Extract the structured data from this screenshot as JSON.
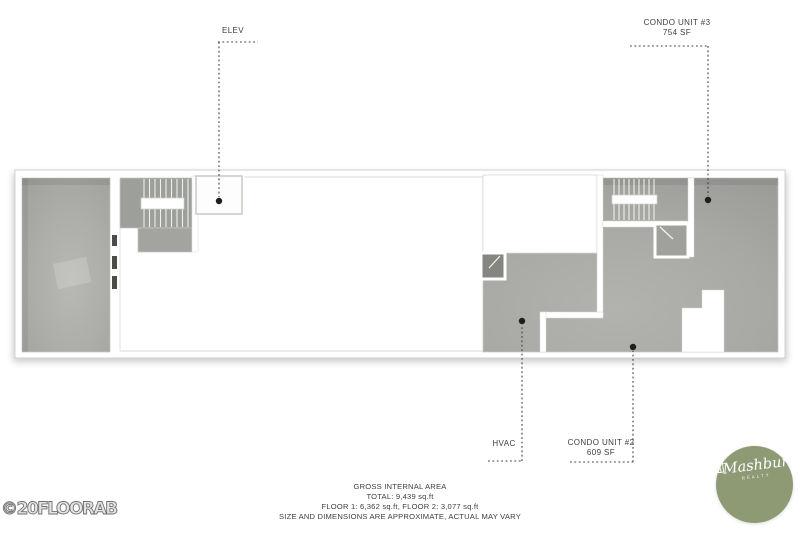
{
  "plan": {
    "labels": {
      "elevator": "ELEV",
      "condo3_title": "CONDO UNIT #3",
      "condo3_area": "754 SF",
      "hvac": "HVAC",
      "condo2_title": "CONDO UNIT #2",
      "condo2_area": "609 SF"
    },
    "footer": {
      "line1": "GROSS INTERNAL AREA",
      "line2": "TOTAL: 9,439 sq.ft",
      "line3": "FLOOR 1: 6,362 sq.ft, FLOOR 2: 3,077 sq.ft",
      "line4": "SIZE AND DIMENSIONS ARE APPROXIMATE, ACTUAL MAY VARY"
    },
    "watermark": "©20FLOORAB",
    "colors": {
      "floor_gray": "#aaaba7",
      "floor_gray_dark": "#85867f",
      "wall_white": "#ffffff",
      "wall_edge": "#ccccc8",
      "leader": "#3f3f3f",
      "text": "#3e3e3e",
      "logo_green": "#8d9a74"
    }
  },
  "logo": {
    "prefix": "the",
    "name": "Mashburn",
    "subtitle": "REALTY",
    "icon": "house-icon"
  }
}
